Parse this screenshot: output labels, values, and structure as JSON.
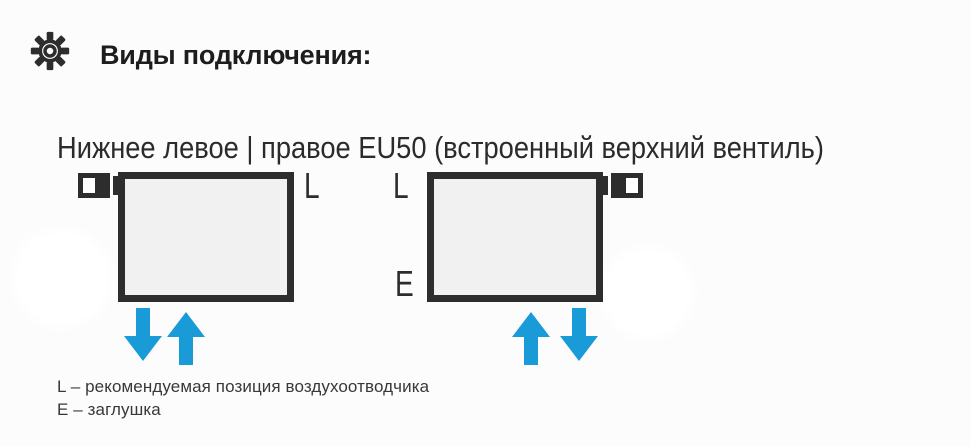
{
  "header": {
    "icon": "gear-icon",
    "title": "Виды подключения:"
  },
  "section": {
    "subtitle": "Нижнее левое | правое EU50 (встроенный верхний вентиль)"
  },
  "diagram": {
    "left_radiator": {
      "valve_position": "top-left",
      "air_vent_label": "L",
      "flow_arrows": [
        "down",
        "up"
      ]
    },
    "right_radiator": {
      "valve_position": "top-right",
      "air_vent_label": "L",
      "plug_label": "E",
      "flow_arrows": [
        "up",
        "down"
      ]
    }
  },
  "legend": {
    "items": [
      "L – рекомендуемая позиция воздухоотводчика",
      "E – заглушка"
    ]
  },
  "colors": {
    "outline_dark": "#2d2d2d",
    "radiator_fill": "#f1f1f1",
    "arrow_blue": "#189bd7",
    "text_dark": "#1d1d1d",
    "legend_text": "#383838"
  }
}
